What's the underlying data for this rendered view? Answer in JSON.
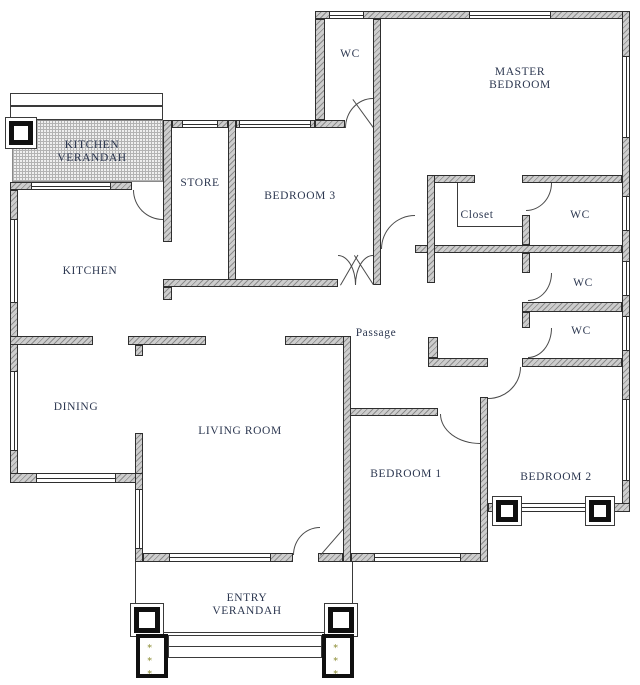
{
  "plan": {
    "rooms": [
      {
        "id": "kitchen-verandah",
        "label": "KITCHEN VERANDAH"
      },
      {
        "id": "store",
        "label": "STORE"
      },
      {
        "id": "bedroom-3",
        "label": "BEDROOM 3"
      },
      {
        "id": "wc-top",
        "label": "WC"
      },
      {
        "id": "master-bedroom",
        "label": "MASTER BEDROOM"
      },
      {
        "id": "closet",
        "label": "Closet"
      },
      {
        "id": "wc-ensuite",
        "label": "WC"
      },
      {
        "id": "wc-middle",
        "label": "WC"
      },
      {
        "id": "wc-lower",
        "label": "WC"
      },
      {
        "id": "kitchen",
        "label": "KITCHEN"
      },
      {
        "id": "passage",
        "label": "Passage"
      },
      {
        "id": "dining",
        "label": "DINING"
      },
      {
        "id": "living-room",
        "label": "LIVING ROOM"
      },
      {
        "id": "bedroom-1",
        "label": "BEDROOM 1"
      },
      {
        "id": "bedroom-2",
        "label": "BEDROOM 2"
      },
      {
        "id": "entry-verandah",
        "label": "ENTRY VERANDAH"
      }
    ],
    "decor": {
      "planter_symbols": "∗ ∗ ∗ ∗"
    },
    "colors": {
      "wall_fill": "#cdcdcd",
      "wall_hatch": "#8c8c8c",
      "line": "#2e2e2e",
      "text": "#2c3750",
      "plant": "#8a8a2f"
    }
  }
}
